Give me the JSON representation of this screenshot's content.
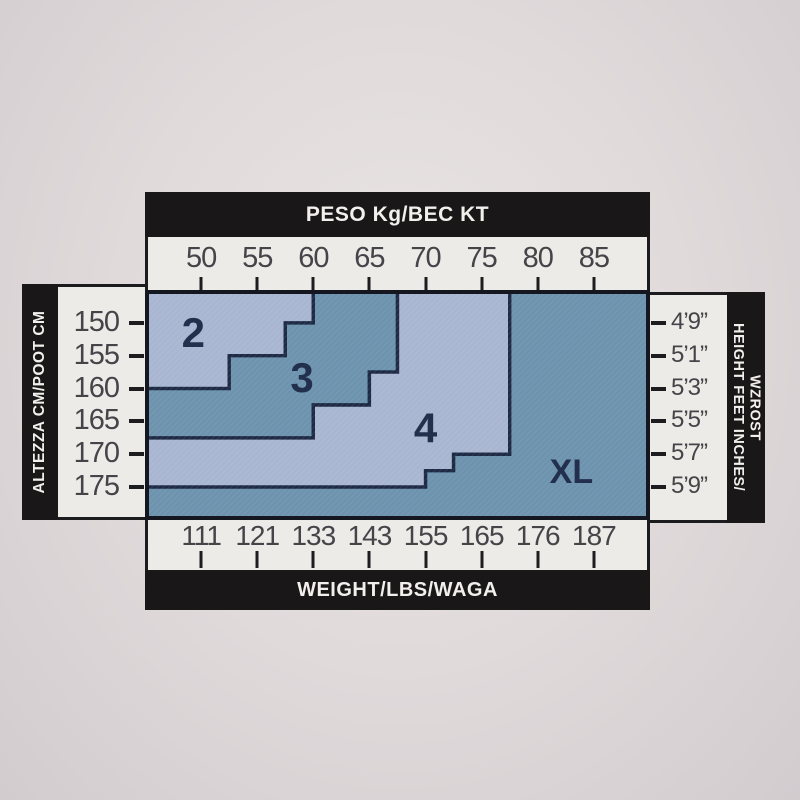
{
  "chart_data": {
    "type": "area",
    "description": "Hosiery size chart: stepped regions mapping body height vs weight to sizes 2, 3, 4, XL",
    "x_range_kg": [
      45,
      90
    ],
    "y_range_cm": [
      145,
      180
    ],
    "axes": {
      "top": {
        "title": "PESO Kg/BEC KT",
        "unit": "kg",
        "ticks": [
          50,
          55,
          60,
          65,
          70,
          75,
          80,
          85
        ]
      },
      "bottom": {
        "title": "WEIGHT/LBS/WAGA",
        "unit": "lbs",
        "ticks": [
          111,
          121,
          133,
          143,
          155,
          165,
          176,
          187
        ]
      },
      "left": {
        "title": "ALTEZZA CM/POOT CM",
        "unit": "cm",
        "ticks": [
          150,
          155,
          160,
          165,
          170,
          175
        ]
      },
      "right": {
        "title_lines": [
          "HEIGHT FEET INCHES/",
          "WZROST"
        ],
        "unit": "feet-inches",
        "ticks": [
          "4’9”",
          "5’1”",
          "5’3”",
          "5’5”",
          "5’7”",
          "5’9”"
        ]
      }
    },
    "regions": [
      {
        "label": "2",
        "tone": "light",
        "label_at": [
          49.3,
          151.5
        ],
        "polygon": [
          [
            45,
            145
          ],
          [
            60,
            145
          ],
          [
            60,
            150
          ],
          [
            57.5,
            150
          ],
          [
            57.5,
            155
          ],
          [
            52.5,
            155
          ],
          [
            52.5,
            160
          ],
          [
            45,
            160
          ]
        ]
      },
      {
        "label": "3",
        "tone": "dark",
        "label_at": [
          59,
          158.3
        ],
        "polygon": [
          [
            60,
            145
          ],
          [
            67.5,
            145
          ],
          [
            67.5,
            157.5
          ],
          [
            65,
            157.5
          ],
          [
            65,
            162.5
          ],
          [
            60,
            162.5
          ],
          [
            60,
            167.5
          ],
          [
            45,
            167.5
          ],
          [
            45,
            160
          ],
          [
            52.5,
            160
          ],
          [
            52.5,
            155
          ],
          [
            57.5,
            155
          ],
          [
            57.5,
            150
          ],
          [
            60,
            150
          ]
        ]
      },
      {
        "label": "4",
        "tone": "light",
        "label_at": [
          70,
          166
        ],
        "polygon": [
          [
            67.5,
            145
          ],
          [
            77.5,
            145
          ],
          [
            77.5,
            170
          ],
          [
            72.5,
            170
          ],
          [
            72.5,
            172.5
          ],
          [
            70,
            172.5
          ],
          [
            70,
            175
          ],
          [
            45,
            175
          ],
          [
            45,
            167.5
          ],
          [
            60,
            167.5
          ],
          [
            60,
            162.5
          ],
          [
            65,
            162.5
          ],
          [
            65,
            157.5
          ],
          [
            67.5,
            157.5
          ]
        ]
      },
      {
        "label": "XL",
        "tone": "dark",
        "label_at": [
          83,
          172.7
        ],
        "polygon": [
          [
            77.5,
            145
          ],
          [
            90,
            145
          ],
          [
            90,
            180
          ],
          [
            45,
            180
          ],
          [
            45,
            175
          ],
          [
            70,
            175
          ],
          [
            70,
            172.5
          ],
          [
            72.5,
            172.5
          ],
          [
            72.5,
            170
          ],
          [
            77.5,
            170
          ]
        ]
      }
    ],
    "colors": {
      "region_light": "#a9b6d1",
      "region_dark": "#6d93ae",
      "region_line": "#1e2a44",
      "frame": "#14171f",
      "bar_bg": "#1a1718",
      "bar_text": "#f2efec",
      "strip_bg": "#edebe7",
      "tick": "#1d1d1f",
      "number_text": "#454449",
      "label_text": "#22304d"
    }
  }
}
